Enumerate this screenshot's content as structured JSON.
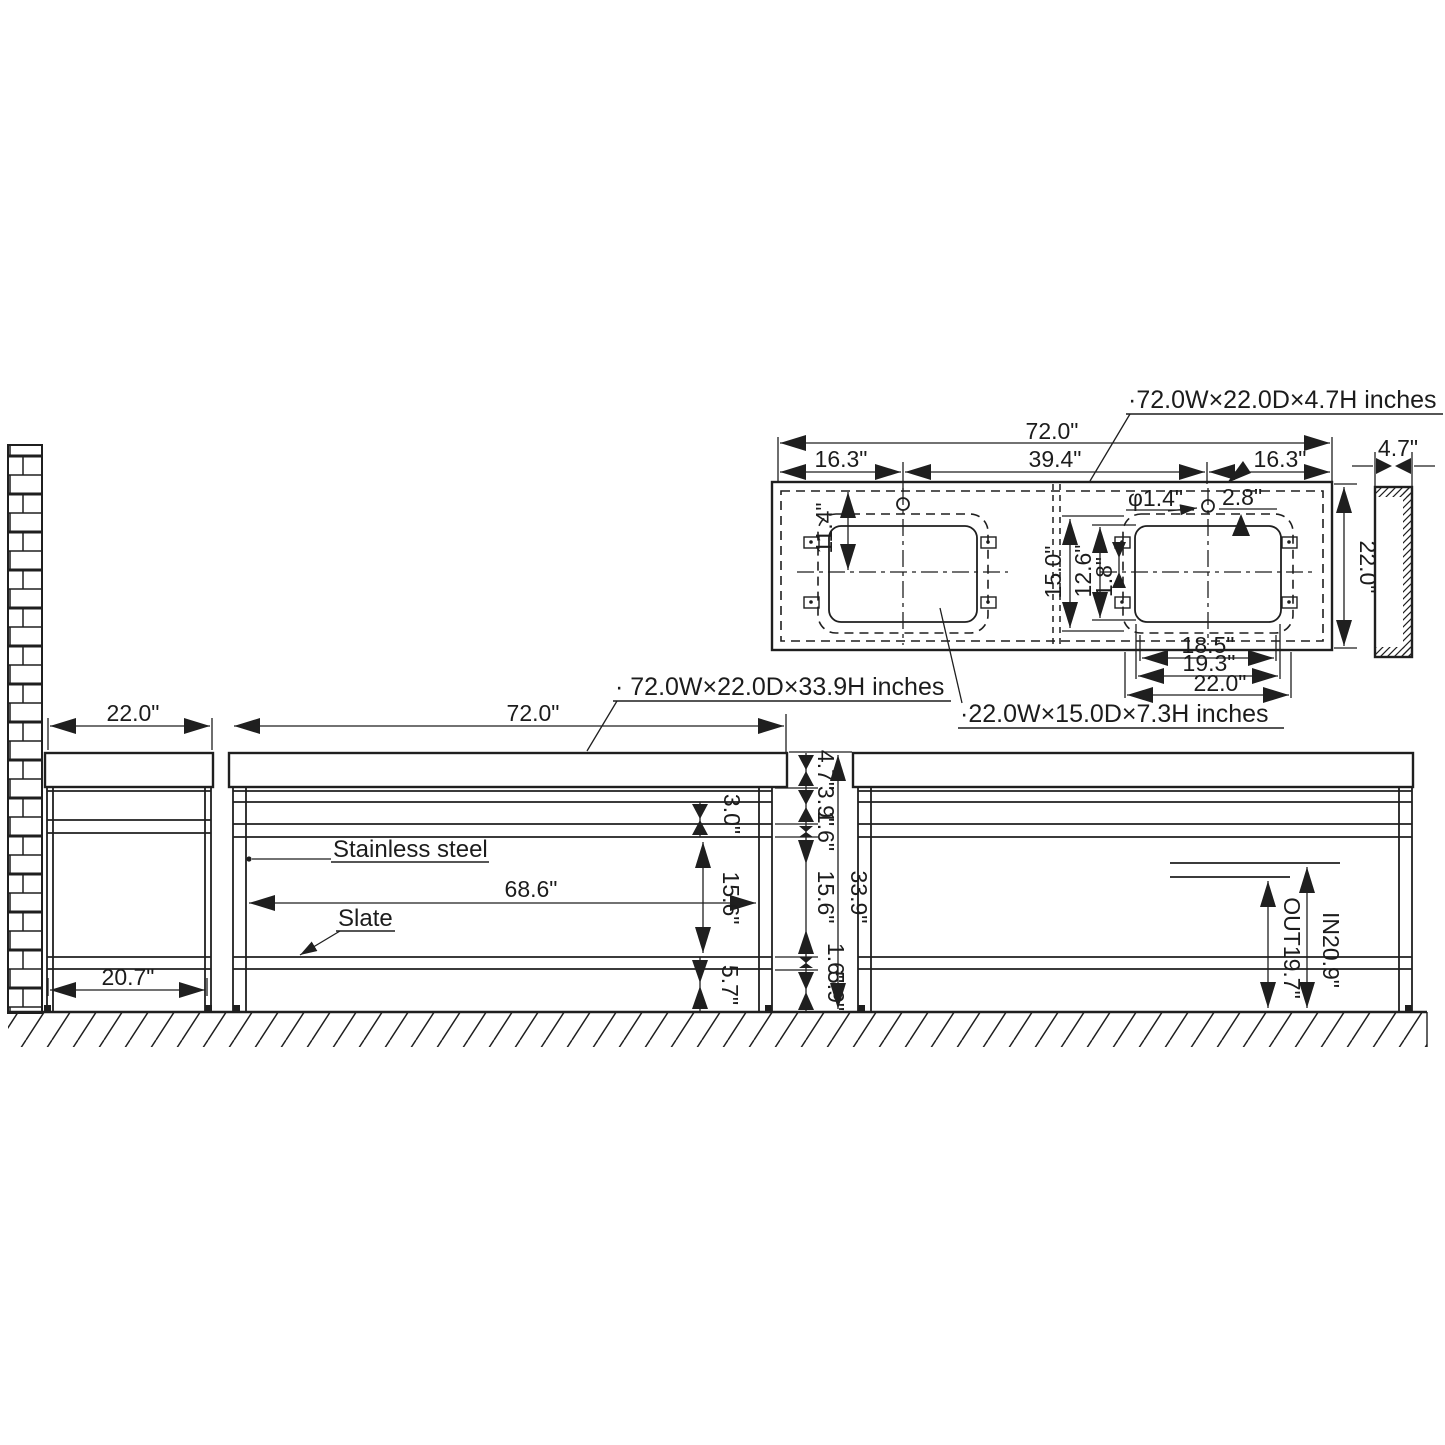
{
  "drawing": {
    "labels": {
      "countertop": "·72.0W×22.0D×4.7H inches",
      "vanity": "· 72.0W×22.0D×33.9H inches",
      "sink": "·22.0W×15.0D×7.3H inches"
    },
    "materials": {
      "frame": "Stainless steel",
      "shelf": "Slate"
    },
    "plan": {
      "overall_width": "72.0\"",
      "left_segment": "16.3\"",
      "center_segment": "39.4\"",
      "right_segment": "16.3\"",
      "depth": "22.0\"",
      "thickness": "4.7\"",
      "faucet_hole_diameter": "φ1.4\"",
      "faucet_hole_spacing": "2.8\"",
      "bowl_center_from_back": "11.4\"",
      "bowl_depth_outer": "15.0\"",
      "bowl_depth_inner": "12.6\"",
      "bowl_offset": "1.8\"",
      "bowl_width_inner": "18.5\"",
      "bowl_width_mid": "19.3\"",
      "bowl_width_outer": "22.0\""
    },
    "side_view": {
      "depth": "22.0\"",
      "shelf_depth": "20.7\""
    },
    "front_view": {
      "width": "72.0\"",
      "inner_width": "68.6\"",
      "apron_height": "3.0\"",
      "shelf_clearance": "15.6\"",
      "base_height": "5.7\"",
      "overall_height": "33.9\"",
      "stack": [
        "4.7\"",
        "3.9\"",
        "1.6\"",
        "15.6\"",
        "1.6\"",
        "5.9\""
      ]
    },
    "back_view": {
      "inlet_height": "IN20.9\"",
      "outlet_height": "OUT19.7\""
    }
  }
}
